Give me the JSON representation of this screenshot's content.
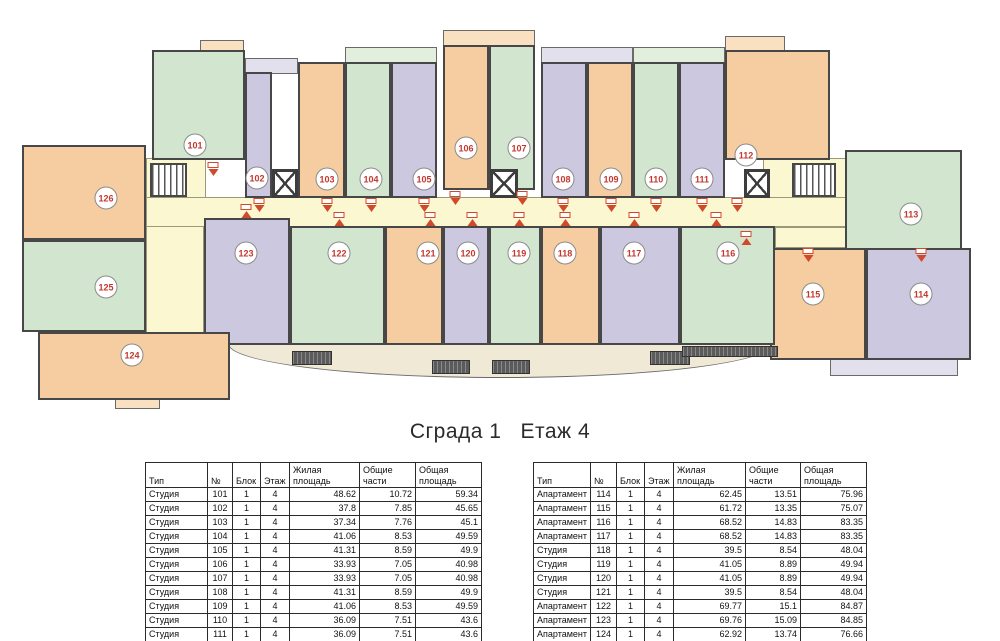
{
  "title": "Сграда 1   Етаж 4",
  "colors": {
    "green": "#d2e5cf",
    "purple": "#cbc8df",
    "orange": "#f5cda1",
    "green_light": "#e3efdd",
    "purple_light": "#e2e0ed",
    "orange_light": "#f9e0c0",
    "corridor": "#fbf8d1",
    "wall": "#474747",
    "balcony": "#efe9d6",
    "circle_text": "#c4372f",
    "arrow": "#cf4a2a"
  },
  "plan": {
    "corridors": [
      {
        "x": 146,
        "y": 197,
        "w": 790,
        "h": 30
      },
      {
        "x": 146,
        "y": 158,
        "w": 60,
        "h": 40
      },
      {
        "x": 146,
        "y": 226,
        "w": 58,
        "h": 107
      },
      {
        "x": 763,
        "y": 158,
        "w": 84,
        "h": 40
      },
      {
        "x": 775,
        "y": 227,
        "w": 161,
        "h": 21
      }
    ],
    "rooms": [
      {
        "num": "101",
        "color": "green",
        "x": 152,
        "y": 50,
        "w": 93,
        "h": 110,
        "cx": 195,
        "cy": 145
      },
      {
        "num": "102",
        "color": "purple",
        "x": 245,
        "y": 72,
        "w": 27,
        "h": 126,
        "cx": 257,
        "cy": 178
      },
      {
        "num": "103",
        "color": "orange",
        "x": 298,
        "y": 62,
        "w": 47,
        "h": 136,
        "cx": 327,
        "cy": 179
      },
      {
        "num": "104",
        "color": "green",
        "x": 345,
        "y": 62,
        "w": 46,
        "h": 136,
        "cx": 371,
        "cy": 179
      },
      {
        "num": "105",
        "color": "purple",
        "x": 391,
        "y": 62,
        "w": 46,
        "h": 136,
        "cx": 424,
        "cy": 179
      },
      {
        "num": "106",
        "color": "orange",
        "x": 443,
        "y": 45,
        "w": 46,
        "h": 145,
        "cx": 466,
        "cy": 148
      },
      {
        "num": "107",
        "color": "green",
        "x": 489,
        "y": 45,
        "w": 46,
        "h": 145,
        "cx": 519,
        "cy": 148
      },
      {
        "num": "108",
        "color": "purple",
        "x": 541,
        "y": 62,
        "w": 46,
        "h": 136,
        "cx": 563,
        "cy": 179
      },
      {
        "num": "109",
        "color": "orange",
        "x": 587,
        "y": 62,
        "w": 46,
        "h": 136,
        "cx": 611,
        "cy": 179
      },
      {
        "num": "110",
        "color": "green",
        "x": 633,
        "y": 62,
        "w": 46,
        "h": 136,
        "cx": 656,
        "cy": 179
      },
      {
        "num": "111",
        "color": "purple",
        "x": 679,
        "y": 62,
        "w": 46,
        "h": 136,
        "cx": 702,
        "cy": 179
      },
      {
        "num": "112",
        "color": "orange",
        "x": 725,
        "y": 50,
        "w": 105,
        "h": 110,
        "cx": 746,
        "cy": 155
      },
      {
        "num": "113",
        "color": "green",
        "x": 845,
        "y": 150,
        "w": 117,
        "h": 137,
        "cx": 911,
        "cy": 214
      },
      {
        "num": "114",
        "color": "purple",
        "x": 866,
        "y": 248,
        "w": 105,
        "h": 112,
        "cx": 921,
        "cy": 294
      },
      {
        "num": "115",
        "color": "orange",
        "x": 770,
        "y": 248,
        "w": 96,
        "h": 112,
        "cx": 813,
        "cy": 294
      },
      {
        "num": "116",
        "color": "green",
        "x": 680,
        "y": 226,
        "w": 95,
        "h": 119,
        "cx": 728,
        "cy": 253
      },
      {
        "num": "117",
        "color": "purple",
        "x": 600,
        "y": 226,
        "w": 80,
        "h": 119,
        "cx": 634,
        "cy": 253
      },
      {
        "num": "118",
        "color": "orange",
        "x": 541,
        "y": 226,
        "w": 59,
        "h": 119,
        "cx": 565,
        "cy": 253
      },
      {
        "num": "119",
        "color": "green",
        "x": 489,
        "y": 226,
        "w": 52,
        "h": 119,
        "cx": 519,
        "cy": 253
      },
      {
        "num": "120",
        "color": "purple",
        "x": 443,
        "y": 226,
        "w": 46,
        "h": 119,
        "cx": 468,
        "cy": 253
      },
      {
        "num": "121",
        "color": "orange",
        "x": 385,
        "y": 226,
        "w": 58,
        "h": 119,
        "cx": 428,
        "cy": 253
      },
      {
        "num": "122",
        "color": "green",
        "x": 290,
        "y": 226,
        "w": 95,
        "h": 119,
        "cx": 339,
        "cy": 253
      },
      {
        "num": "123",
        "color": "purple",
        "x": 204,
        "y": 218,
        "w": 86,
        "h": 127,
        "cx": 246,
        "cy": 253
      },
      {
        "num": "124",
        "color": "orange",
        "x": 38,
        "y": 332,
        "w": 192,
        "h": 68,
        "cx": 132,
        "cy": 355
      },
      {
        "num": "125",
        "color": "green",
        "x": 22,
        "y": 240,
        "w": 124,
        "h": 92,
        "cx": 106,
        "cy": 287
      },
      {
        "num": "126",
        "color": "orange",
        "x": 22,
        "y": 145,
        "w": 124,
        "h": 95,
        "cx": 106,
        "cy": 198
      }
    ],
    "stairs": [
      {
        "x": 150,
        "y": 163,
        "w": 37,
        "h": 34
      },
      {
        "x": 792,
        "y": 163,
        "w": 44,
        "h": 34
      }
    ],
    "elevators": [
      {
        "x": 272,
        "y": 169,
        "w": 26,
        "h": 29
      },
      {
        "x": 490,
        "y": 169,
        "w": 28,
        "h": 29
      },
      {
        "x": 744,
        "y": 169,
        "w": 26,
        "h": 29
      }
    ],
    "balconies": [
      {
        "x": 200,
        "y": 40,
        "w": 44,
        "h": 14,
        "color": "orange_light"
      },
      {
        "x": 245,
        "y": 58,
        "w": 53,
        "h": 16,
        "color": "purple_light"
      },
      {
        "x": 345,
        "y": 47,
        "w": 92,
        "h": 17,
        "color": "green_light"
      },
      {
        "x": 443,
        "y": 30,
        "w": 92,
        "h": 17,
        "color": "orange_light"
      },
      {
        "x": 541,
        "y": 47,
        "w": 92,
        "h": 17,
        "color": "purple_light"
      },
      {
        "x": 633,
        "y": 47,
        "w": 92,
        "h": 17,
        "color": "green_light"
      },
      {
        "x": 725,
        "y": 36,
        "w": 60,
        "h": 16,
        "color": "orange_light"
      },
      {
        "x": 228,
        "y": 340,
        "w": 545,
        "h": 38,
        "color": "balcony",
        "curved": true
      },
      {
        "x": 830,
        "y": 358,
        "w": 128,
        "h": 18,
        "color": "purple_light"
      },
      {
        "x": 115,
        "y": 398,
        "w": 45,
        "h": 11,
        "color": "orange_light"
      }
    ],
    "railings": [
      {
        "x": 292,
        "y": 351,
        "w": 40,
        "h": 14
      },
      {
        "x": 432,
        "y": 360,
        "w": 38,
        "h": 14
      },
      {
        "x": 492,
        "y": 360,
        "w": 38,
        "h": 14
      },
      {
        "x": 650,
        "y": 351,
        "w": 40,
        "h": 14
      },
      {
        "x": 682,
        "y": 346,
        "w": 96,
        "h": 11
      }
    ],
    "markers": [
      {
        "x": 213,
        "y": 162,
        "dir": "down"
      },
      {
        "x": 259,
        "y": 198,
        "dir": "down"
      },
      {
        "x": 327,
        "y": 198,
        "dir": "down"
      },
      {
        "x": 371,
        "y": 198,
        "dir": "down"
      },
      {
        "x": 424,
        "y": 198,
        "dir": "down"
      },
      {
        "x": 455,
        "y": 191,
        "dir": "down"
      },
      {
        "x": 522,
        "y": 191,
        "dir": "down"
      },
      {
        "x": 563,
        "y": 198,
        "dir": "down"
      },
      {
        "x": 611,
        "y": 198,
        "dir": "down"
      },
      {
        "x": 656,
        "y": 198,
        "dir": "down"
      },
      {
        "x": 702,
        "y": 198,
        "dir": "down"
      },
      {
        "x": 737,
        "y": 198,
        "dir": "down"
      },
      {
        "x": 246,
        "y": 204,
        "dir": "up"
      },
      {
        "x": 339,
        "y": 212,
        "dir": "up"
      },
      {
        "x": 430,
        "y": 212,
        "dir": "up"
      },
      {
        "x": 472,
        "y": 212,
        "dir": "up"
      },
      {
        "x": 519,
        "y": 212,
        "dir": "up"
      },
      {
        "x": 565,
        "y": 212,
        "dir": "up"
      },
      {
        "x": 634,
        "y": 212,
        "dir": "up"
      },
      {
        "x": 716,
        "y": 212,
        "dir": "up"
      },
      {
        "x": 746,
        "y": 231,
        "dir": "up"
      },
      {
        "x": 808,
        "y": 248,
        "dir": "down"
      },
      {
        "x": 921,
        "y": 248,
        "dir": "down"
      }
    ]
  },
  "tables": {
    "headers": [
      "Тип",
      "№",
      "Блок",
      "Этаж",
      "Жилая площадь",
      "Общие части",
      "Общая площадь"
    ],
    "left": {
      "x": 145,
      "col_widths": [
        62,
        25,
        28,
        29,
        70,
        56,
        66
      ],
      "rows": [
        [
          "Студия",
          "101",
          "1",
          "4",
          "48.62",
          "10.72",
          "59.34"
        ],
        [
          "Студия",
          "102",
          "1",
          "4",
          "37.8",
          "7.85",
          "45.65"
        ],
        [
          "Студия",
          "103",
          "1",
          "4",
          "37.34",
          "7.76",
          "45.1"
        ],
        [
          "Студия",
          "104",
          "1",
          "4",
          "41.06",
          "8.53",
          "49.59"
        ],
        [
          "Студия",
          "105",
          "1",
          "4",
          "41.31",
          "8.59",
          "49.9"
        ],
        [
          "Студия",
          "106",
          "1",
          "4",
          "33.93",
          "7.05",
          "40.98"
        ],
        [
          "Студия",
          "107",
          "1",
          "4",
          "33.93",
          "7.05",
          "40.98"
        ],
        [
          "Студия",
          "108",
          "1",
          "4",
          "41.31",
          "8.59",
          "49.9"
        ],
        [
          "Студия",
          "109",
          "1",
          "4",
          "41.06",
          "8.53",
          "49.59"
        ],
        [
          "Студия",
          "110",
          "1",
          "4",
          "36.09",
          "7.51",
          "43.6"
        ],
        [
          "Студия",
          "111",
          "1",
          "4",
          "36.09",
          "7.51",
          "43.6"
        ],
        [
          "Студия",
          "112",
          "1",
          "4",
          "50.64",
          "10.53",
          "61.17"
        ]
      ]
    },
    "right": {
      "x": 533,
      "col_widths": [
        57,
        26,
        28,
        29,
        72,
        55,
        66
      ],
      "rows": [
        [
          "Апартамент",
          "114",
          "1",
          "4",
          "62.45",
          "13.51",
          "75.96"
        ],
        [
          "Апартамент",
          "115",
          "1",
          "4",
          "61.72",
          "13.35",
          "75.07"
        ],
        [
          "Апартамент",
          "116",
          "1",
          "4",
          "68.52",
          "14.83",
          "83.35"
        ],
        [
          "Апартамент",
          "117",
          "1",
          "4",
          "68.52",
          "14.83",
          "83.35"
        ],
        [
          "Студия",
          "118",
          "1",
          "4",
          "39.5",
          "8.54",
          "48.04"
        ],
        [
          "Студия",
          "119",
          "1",
          "4",
          "41.05",
          "8.89",
          "49.94"
        ],
        [
          "Студия",
          "120",
          "1",
          "4",
          "41.05",
          "8.89",
          "49.94"
        ],
        [
          "Студия",
          "121",
          "1",
          "4",
          "39.5",
          "8.54",
          "48.04"
        ],
        [
          "Апартамент",
          "122",
          "1",
          "4",
          "69.77",
          "15.1",
          "84.87"
        ],
        [
          "Апартамент",
          "123",
          "1",
          "4",
          "69.76",
          "15.09",
          "84.85"
        ],
        [
          "Апартамент",
          "124",
          "1",
          "4",
          "62.92",
          "13.74",
          "76.66"
        ],
        [
          "Апартамент",
          "125",
          "1",
          "4",
          "61.57",
          "13.58",
          "75.15"
        ]
      ]
    }
  }
}
